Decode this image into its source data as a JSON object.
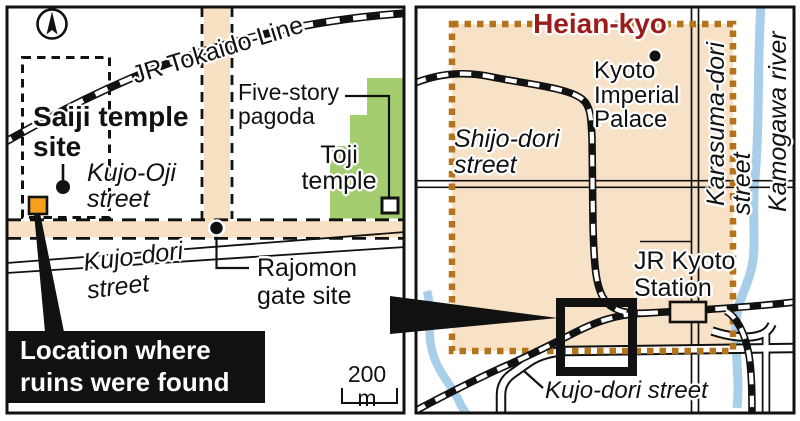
{
  "panels": {
    "left": {
      "railway_label": "JR Tokaido Line",
      "saiji_site": "Saiji temple\nsite",
      "kujo_oji": "Kujo-Oji\nstreet",
      "five_story": "Five-story\npagoda",
      "toji": "Toji\ntemple",
      "kujo_dori": "Kujo-dori\nstreet",
      "rajomon": "Rajomon\ngate site",
      "callout": "Location where\nruins were found",
      "scale": "200 m"
    },
    "right": {
      "title": "Heian-kyo",
      "imperial_palace": "Kyoto\nImperial\nPalace",
      "shijo": "Shijo-dori\nstreet",
      "karasuma": "Karasuma-dori",
      "karasuma_street": "street",
      "kamogawa": "Kamogawa river",
      "station": "JR Kyoto\nStation",
      "kujo_dori": "Kujo-dori street"
    }
  },
  "colors": {
    "ink": "#111111",
    "street_fill": "#f8e0c2",
    "heian_fill": "#f8e2c7",
    "heian_border": "#b4731d",
    "temple_green": "#a4cd70",
    "ruins_orange": "#f4a01d",
    "title_red": "#9c1b1b",
    "river_blue": "#a8cee9"
  },
  "icons": {
    "compass": "north-arrow-icon"
  }
}
